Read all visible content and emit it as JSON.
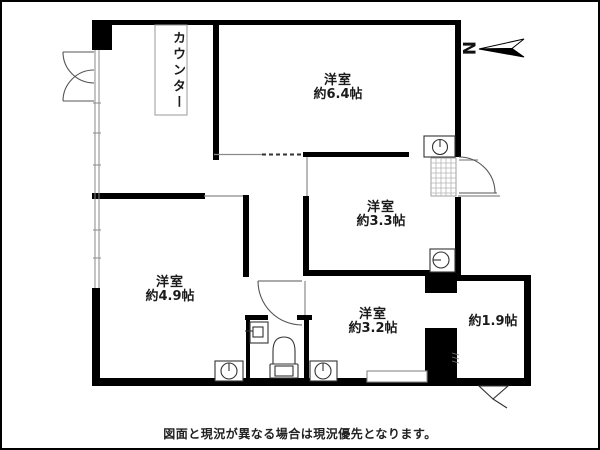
{
  "compass": {
    "label": "N"
  },
  "counter": {
    "label": "カウンター"
  },
  "rooms": {
    "r64": {
      "name": "洋室",
      "size": "約6.4帖"
    },
    "r33": {
      "name": "洋室",
      "size": "約3.3帖"
    },
    "r49": {
      "name": "洋室",
      "size": "約4.9帖"
    },
    "r32": {
      "name": "洋室",
      "size": "約3.2帖"
    },
    "r19": {
      "size": "約1.9帖"
    }
  },
  "footer": {
    "disclaimer": "図面と現況が異なる場合は現況優先となります。"
  },
  "colors": {
    "wall": "#000000",
    "thin_line": "#8a8a8a",
    "hatch": "#b5b5b5",
    "background": "#ffffff",
    "text": "#1a1a1a"
  }
}
